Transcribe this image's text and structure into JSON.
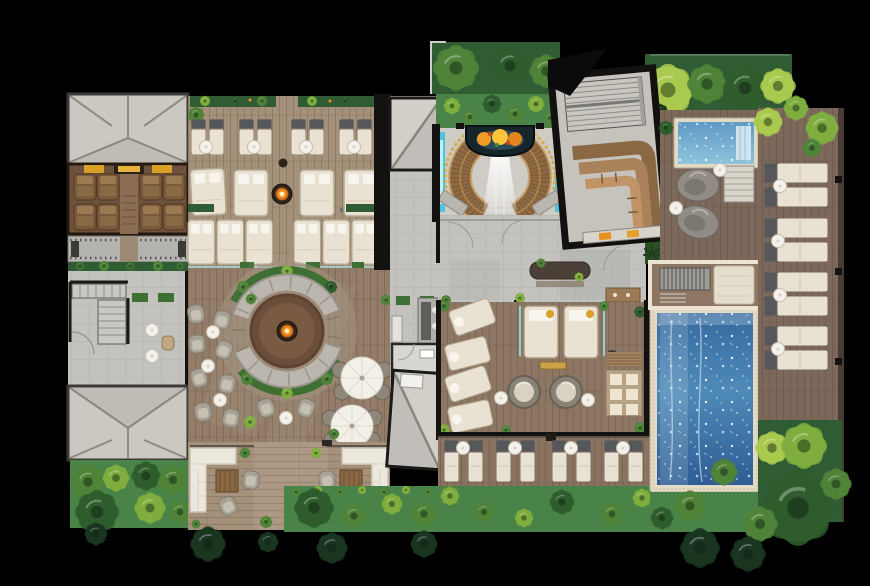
{
  "meta": {
    "title": "Wellness resort spa — top-down architectural floor plan rendering",
    "type": "architectural floor plan, photorealistic top view",
    "canvas_px": {
      "width": 870,
      "height": 586
    },
    "has_visible_text": false
  },
  "palette": {
    "background": "#000000",
    "wall": "#141210",
    "roof_gray": "#cbc8c2",
    "roof_ridge": "#8f8b84",
    "stone_floor": "#c3c2be",
    "deck_wood_light": "#a5907a",
    "deck_wood_mid": "#937d68",
    "deck_wood_dark": "#7d695b",
    "feature_wood": "#8f6a42",
    "feature_wood_trim": "#caa36b",
    "pool_deep": "#2e5d94",
    "pool_light": "#8fc3dd",
    "pool_tile_border": "#e3dac6",
    "teal_glow": "#3ec3e0",
    "glass_partition": "#8fd0d0",
    "grass_dark": "#2f5c33",
    "grass_mid": "#4a8348",
    "tree_dark": "#2e5c2c",
    "tree_mid": "#4f8338",
    "tree_light": "#7fae3f",
    "tree_pale": "#a9c94f",
    "cushion_cream": "#e9e2d2",
    "lounger_head_gray": "#55575a",
    "sofa_white": "#ece8dd",
    "furniture_gray": "#a19b8f",
    "fire_orange": "#f08c1e",
    "fire_glow": "#ffc83d",
    "accent_gold": "#d9a028",
    "towel_orange": "#e8921d"
  },
  "areas": [
    {
      "id": "north-pavilion",
      "label": "Roofed pavilion (north-west) with recliner room and pebble bench strip"
    },
    {
      "id": "west-stone-hall",
      "label": "Stone hall with twin staircases and planters"
    },
    {
      "id": "south-pavilion",
      "label": "Roofed pavilion (south-west)"
    },
    {
      "id": "north-sun-deck",
      "label": "Sun deck: 8 slim loungers, 10 daybeds, fire bowl"
    },
    {
      "id": "fire-pit-lounge",
      "label": "Circular fire-pit lounge ringed by curved sofas and planting"
    },
    {
      "id": "umbrella-dining",
      "label": "Two round tables with white umbrellas and wicker chairs"
    },
    {
      "id": "south-terrace",
      "label": "Terrace with two L-shaped white sofas, wood coffee tables, armchairs"
    },
    {
      "id": "entry-water-court",
      "label": "Entry court: horseshoe timber feature, lotus pond, waterfall floor, teal light slots"
    },
    {
      "id": "north-garden",
      "label": "Two-tier planted garden above the entry court"
    },
    {
      "id": "stair-lounge-hall",
      "label": "Rotated hall with switchback stair and tiered timber bench"
    },
    {
      "id": "reception-hall",
      "label": "Stone reception hall with long table and towel console"
    },
    {
      "id": "relaxation-rooms",
      "label": "Relaxation rooms: angled daybeds, twin daybeds with gold pillows, papasan chairs, towel shelf"
    },
    {
      "id": "south-lounger-row",
      "label": "Row of 8 poolside loungers with round side tables"
    },
    {
      "id": "main-pool",
      "label": "Main rectangular pool with mosaic tile border and sparkling water"
    },
    {
      "id": "plunge-pool",
      "label": "Small plunge pool with interior steps and rock loungers"
    },
    {
      "id": "east-pool-deck",
      "label": "East timber deck: 4 pairs of double loungers with side tables"
    },
    {
      "id": "gardens",
      "label": "Perimeter tropical gardens with layered trees"
    }
  ],
  "inventory": {
    "pools": 2,
    "fire_features": 2,
    "sun_loungers_north": 8,
    "daybeds_north_deck": 10,
    "recliner_chairs": 8,
    "angled_daybeds_relaxation": 4,
    "twin_daybeds_relaxation": 2,
    "papasan_chairs": 2,
    "umbrella_tables": 2,
    "l_shaped_sofas": 2,
    "south_loungers": 8,
    "east_double_loungers": 8,
    "rock_loungers": 2
  }
}
